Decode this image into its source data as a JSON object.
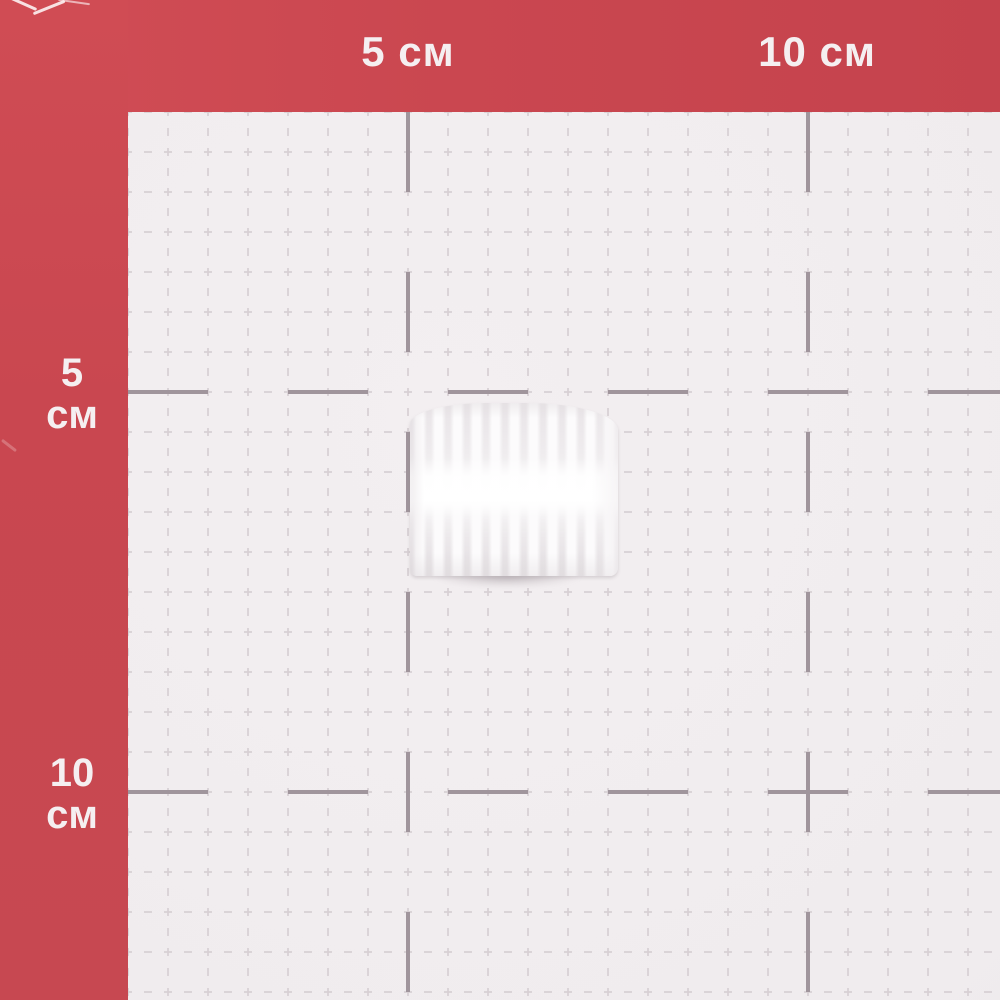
{
  "scene": {
    "kind": "photo of a small white ribbed plastic part on a red measuring mat"
  },
  "mat": {
    "unit": "см",
    "top_labels": [
      "5 см",
      "10 см"
    ],
    "left_labels": [
      {
        "value": "5",
        "unit": "см"
      },
      {
        "value": "10",
        "unit": "см"
      }
    ],
    "grid": {
      "origin_x": 128,
      "origin_y": 112,
      "minor_step_px": 40,
      "extent_w": 1000,
      "extent_h": 1000,
      "major_x": [
        408,
        808
      ],
      "major_y": [
        392,
        792
      ],
      "px_per_cm": 80,
      "major_interval_cm": 5
    },
    "colors": {
      "border_red": "#ca4750",
      "grid_background": "#f1edef",
      "grid_minor_line": "#d7d0d4",
      "grid_major_tick": "#a0959c",
      "label_text": "#f5eff1"
    }
  },
  "object": {
    "color": "#fcfbfc",
    "bounds_px": {
      "left": 410,
      "top": 403,
      "width": 208,
      "height": 173
    }
  }
}
